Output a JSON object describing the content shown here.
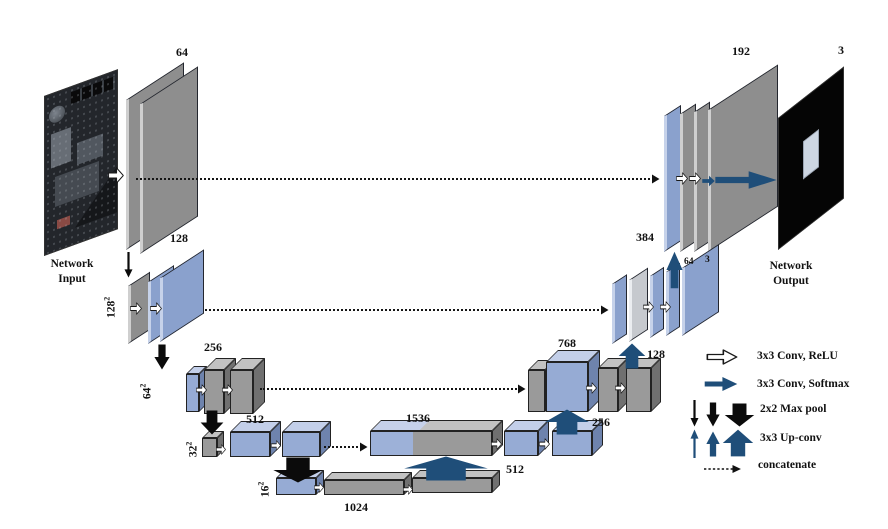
{
  "colors": {
    "navy": "#1f4e79",
    "steel_blue": "#8aa1cd",
    "gray": "#9a9a9a",
    "black_arrow": "#0b0b0b"
  },
  "io": {
    "input_caption": [
      "Network",
      "Input"
    ],
    "output_caption": [
      "Network",
      "Output"
    ]
  },
  "channel_labels": {
    "enc_l1": "64",
    "enc_l2": "128",
    "enc_l3": "256",
    "enc_l4": "512",
    "bottleneck": "1024",
    "dec_l4_concat": "1536",
    "dec_l4_conv": "512",
    "dec_l4_up": "256",
    "dec_l3_concat": "768",
    "dec_l3_up": "128",
    "dec_l2_concat": "384",
    "dec_l2_conv": "64",
    "dec_l2_out": "3",
    "dec_l1_concat": "192",
    "output": "3"
  },
  "spatial_labels": [
    {
      "base": "128",
      "sup": "2"
    },
    {
      "base": "64",
      "sup": "2"
    },
    {
      "base": "32",
      "sup": "2"
    },
    {
      "base": "16",
      "sup": "2"
    }
  ],
  "legend": {
    "items": [
      {
        "name": "conv-relu",
        "label": "3x3 Conv, ReLU"
      },
      {
        "name": "conv-softmax",
        "label": "3x3 Conv, Softmax"
      },
      {
        "name": "maxpool",
        "label": "2x2 Max pool"
      },
      {
        "name": "upconv",
        "label": "3x3 Up-conv"
      },
      {
        "name": "concatenate",
        "label": "concatenate"
      }
    ]
  }
}
